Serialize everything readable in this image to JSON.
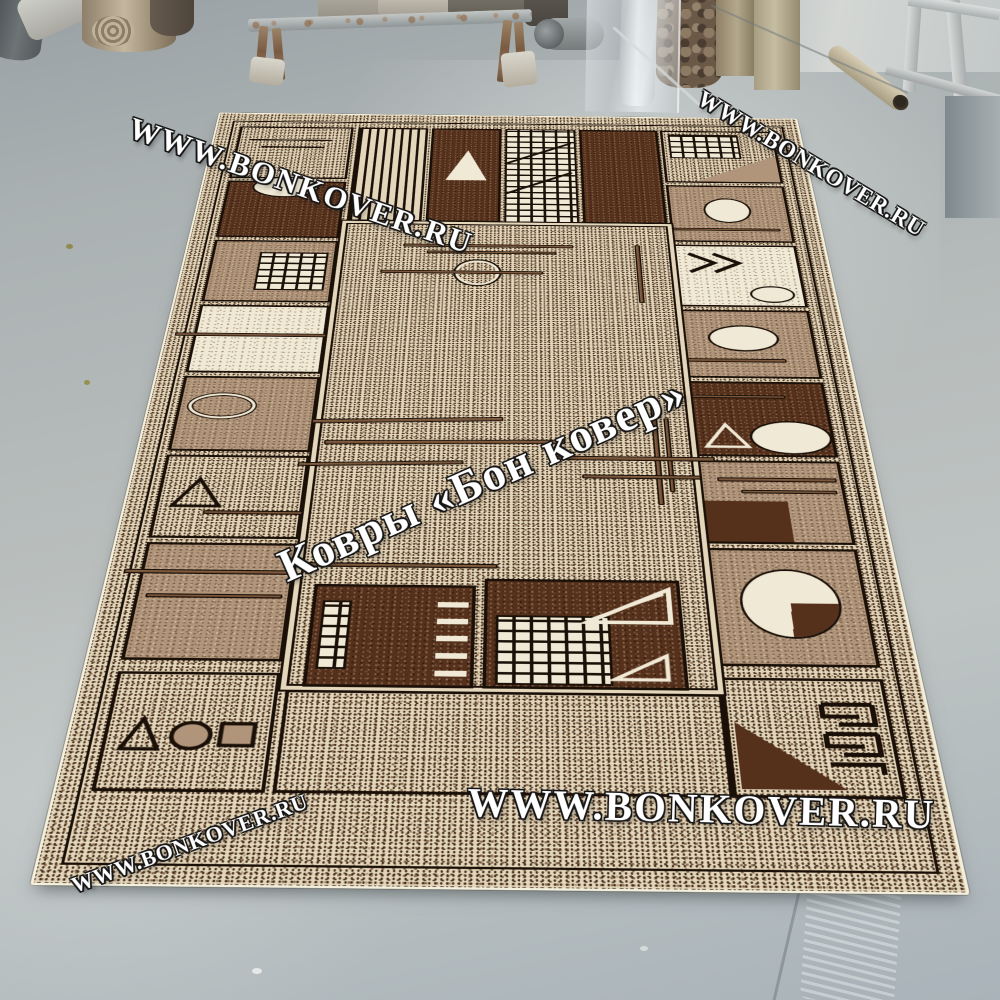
{
  "scene": {
    "watermarks": {
      "top_left": "WWW.BONKOVER.RU",
      "top_right": "WWW.BONKOVER.RU",
      "center": "Ковры «Бон ковер»",
      "bottom": "WWW.BONKOVER.RU",
      "bottom_left": "WWW.BONKOVER.RU"
    },
    "palette": {
      "floor_top": "#99a1a5",
      "floor_mid": "#b9bebd",
      "floor_bottom": "#a9b3b9",
      "rug_cream": "#e3d6ba",
      "rug_light": "#f0e9d5",
      "rug_taupe": "#b0957a",
      "rug_brown": "#7d5a3e",
      "rug_dark": "#55301b",
      "rug_outline": "#1a1008",
      "rug_edge": "#f5f0de",
      "watermark": "#ffffff"
    }
  }
}
